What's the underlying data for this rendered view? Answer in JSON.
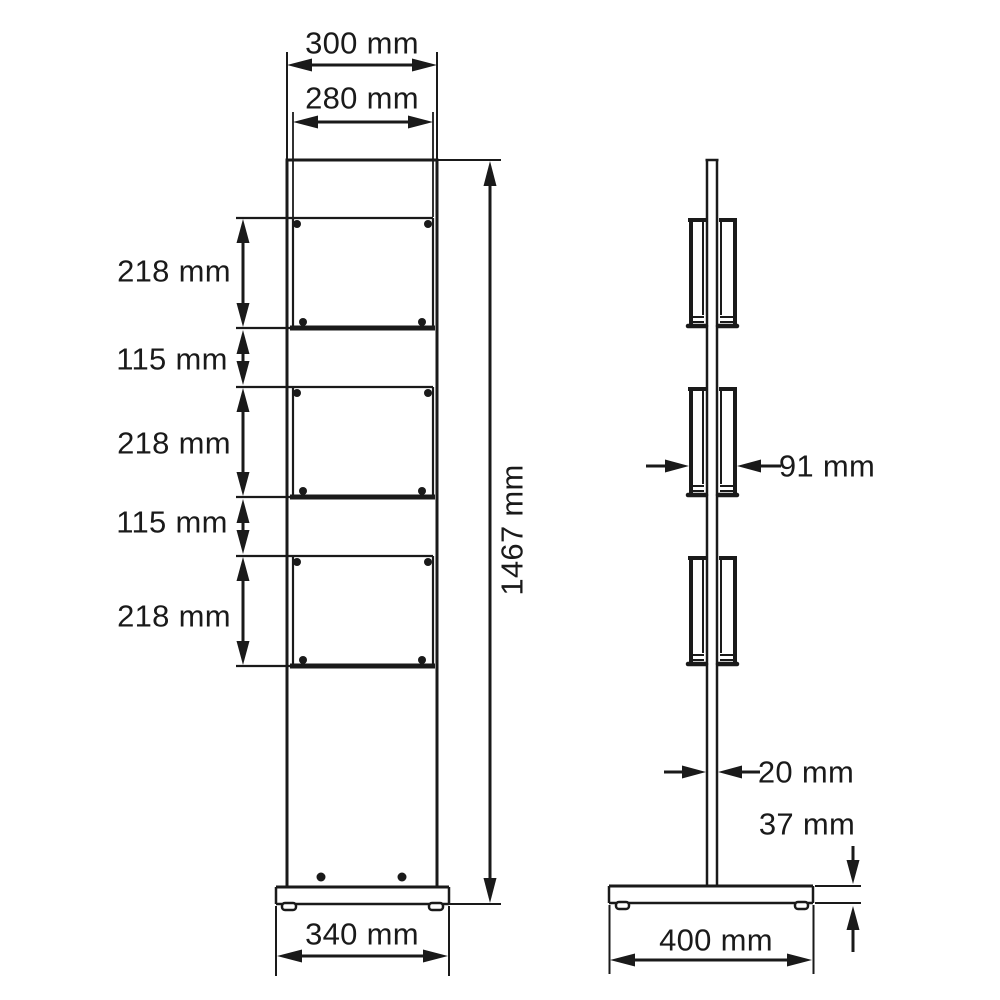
{
  "dimensions": {
    "front": {
      "top_width": "300 mm",
      "pocket_width": "280 mm",
      "pocket_height_1": "218 mm",
      "gap_1": "115 mm",
      "pocket_height_2": "218 mm",
      "gap_2": "115 mm",
      "pocket_height_3": "218 mm",
      "total_height": "1467 mm",
      "base_width": "340 mm"
    },
    "side": {
      "pocket_depth": "91 mm",
      "pole_thickness": "20 mm",
      "base_height": "37 mm",
      "base_depth": "400 mm"
    }
  },
  "colors": {
    "ink": "#1a1a1a",
    "background": "#ffffff"
  }
}
